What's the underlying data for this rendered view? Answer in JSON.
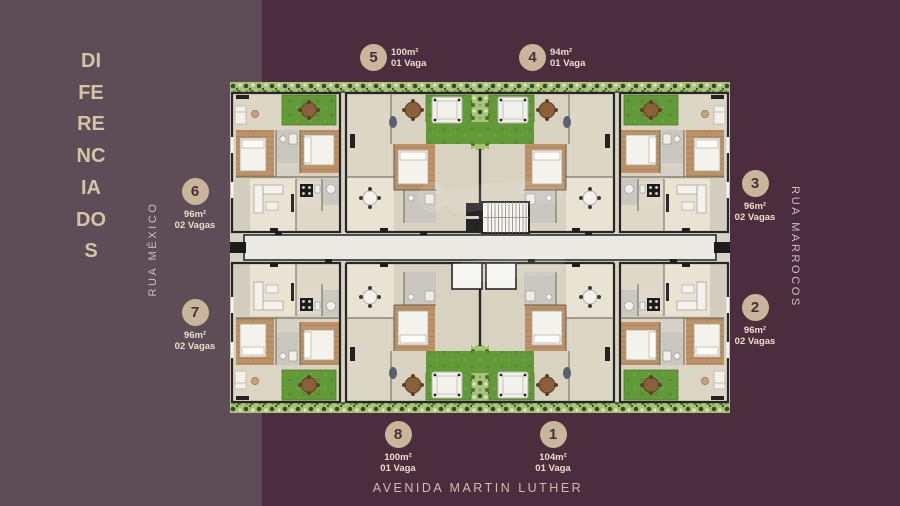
{
  "title": {
    "text": "DIFERENCIADOS"
  },
  "streets": {
    "left": "RUA MÉXICO",
    "right": "RUA MARROCOS",
    "bottom": "AVENIDA MARTIN LUTHER"
  },
  "units": {
    "u1": {
      "number": "1",
      "area": "104m²",
      "parking": "01 Vaga"
    },
    "u2": {
      "number": "2",
      "area": "96m²",
      "parking": "02 Vagas"
    },
    "u3": {
      "number": "3",
      "area": "96m²",
      "parking": "02 Vagas"
    },
    "u4": {
      "number": "4",
      "area": "94m²",
      "parking": "01 Vaga"
    },
    "u5": {
      "number": "5",
      "area": "100m²",
      "parking": "01 Vaga"
    },
    "u6": {
      "number": "6",
      "area": "96m²",
      "parking": "02 Vagas"
    },
    "u7": {
      "number": "7",
      "area": "96m²",
      "parking": "02 Vagas"
    },
    "u8": {
      "number": "8",
      "area": "100m²",
      "parking": "01 Vaga"
    }
  },
  "colors": {
    "panel_left": "#5e4c56",
    "panel_right": "#4c2d3d",
    "badge_fill": "#c8b69a",
    "badge_text": "#4a2c3a",
    "stats_text": "#eadfc8",
    "title_text": "#d3c4a7",
    "street_text": "#c9c0c4",
    "plan_floor": "#d8d2c1",
    "plan_lawn": "#639a3a",
    "plan_wood": "#bd9267",
    "plan_wall": "#262626"
  }
}
